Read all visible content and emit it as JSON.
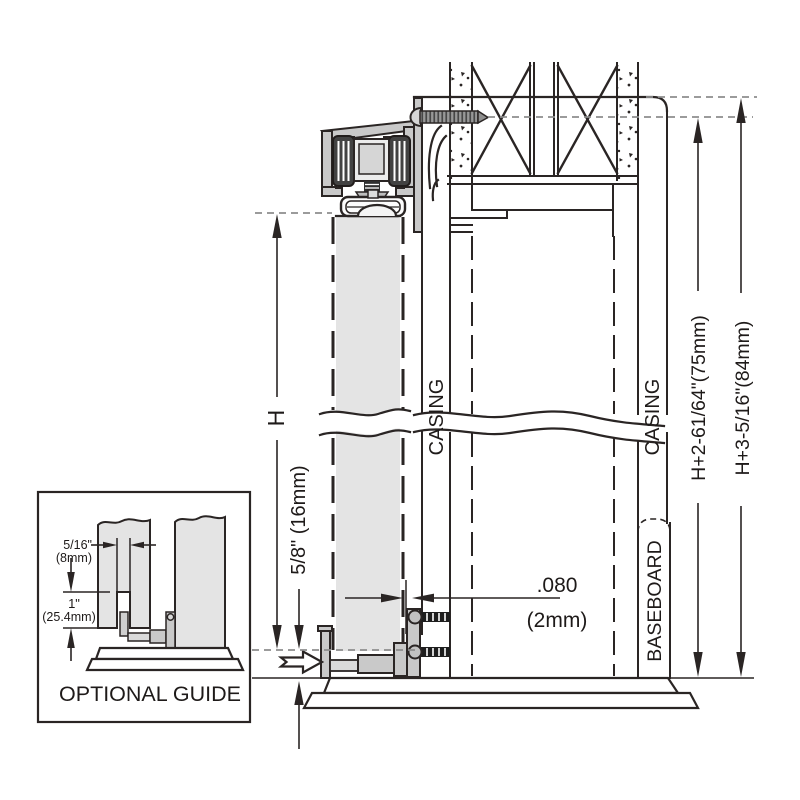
{
  "diagram": {
    "labels": {
      "casing_left": "CASING",
      "casing_right": "CASING",
      "baseboard": "BASEBOARD",
      "door_height": "H",
      "bottom_clearance": "5/8\" (16mm)",
      "track_height": "H+2-61/64\"(75mm)",
      "overall_height": "H+3-5/16\"(84mm)",
      "gap_inches": ".080",
      "gap_mm": "(2mm)"
    },
    "inset": {
      "title": "OPTIONAL GUIDE",
      "groove_width_in": "5/16\"",
      "groove_width_mm": "(8mm)",
      "groove_depth_in": "1\"",
      "groove_depth_mm": "(25.4mm)"
    },
    "colors": {
      "line": "#2a2524",
      "door_panel": "#e4e4e4",
      "hardware": "#c9c9c9",
      "reference_dash": "#8d8d8d",
      "background": "#ffffff"
    }
  }
}
